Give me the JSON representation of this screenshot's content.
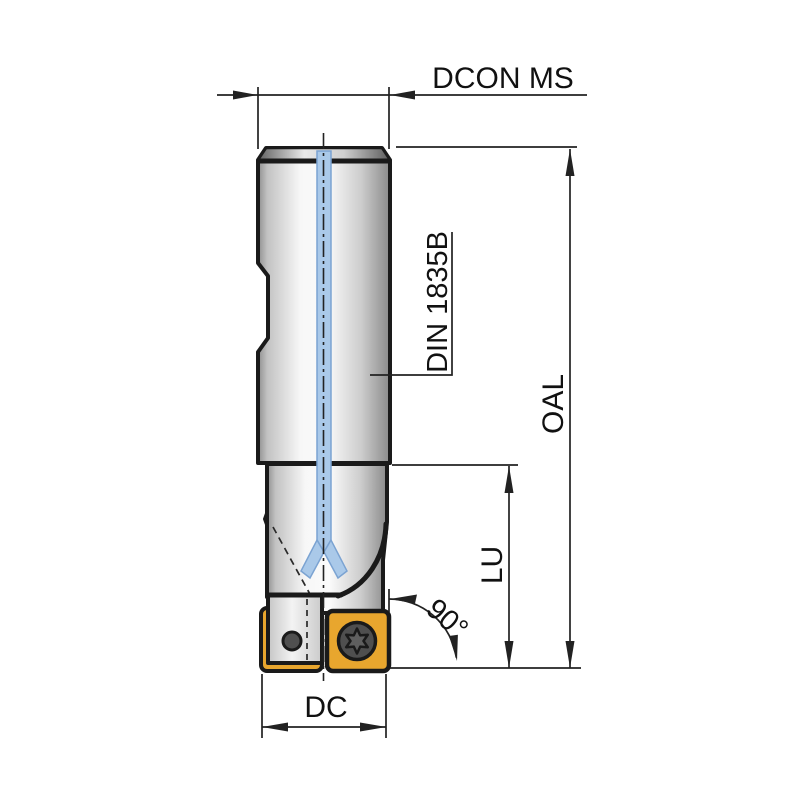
{
  "diagram": {
    "type": "technical-drawing",
    "subject": "indexable-end-mill-side-view-with-coolant-channels",
    "labels": {
      "shank_diameter": "DCON MS",
      "shank_standard": "DIN 1835B",
      "overall_length": "OAL",
      "usable_length": "LU",
      "entering_angle": "90°",
      "cutting_diameter": "DC"
    },
    "colors": {
      "outline": "#1a1a1a",
      "dimension_line": "#222222",
      "coolant_channel_blue": "#aac9e9",
      "coolant_channel_edge": "#7ba3d2",
      "insert_yellow": "#e8a62e",
      "screw_gray": "#4f4f4f",
      "screw_star_gray": "#5f5f5f",
      "background": "#ffffff"
    }
  }
}
